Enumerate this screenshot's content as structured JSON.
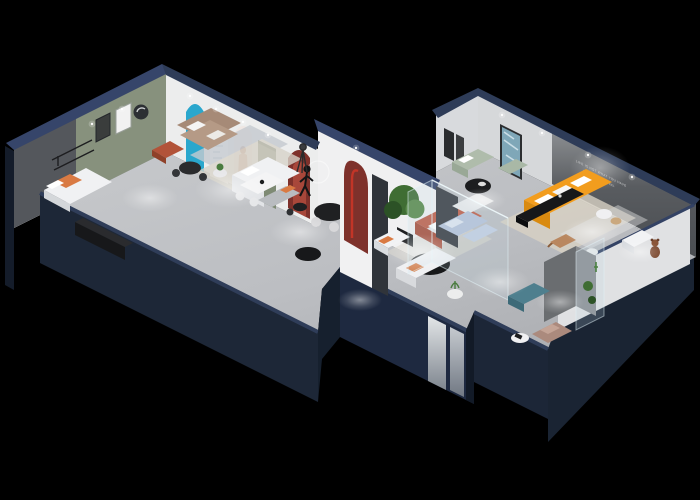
{
  "scene": {
    "title": "isometric-furniture-showroom-floor-plan",
    "wall_slogan": {
      "line1": "LIFE IS NOT WHAT YOU HAVE",
      "line2": "IT IS WHAT YOU FEEL"
    },
    "colors": {
      "bg": "#000000",
      "outerWallFace": "#1d2737",
      "outerWallSide": "#141c2a",
      "outerWallRight": "#1a2433",
      "wallCap": "#36456a",
      "capLine": "#2f3d59",
      "interiorWall": "#e9eaec",
      "interiorWallShade": "#d8dadd",
      "rightInnerWall": "#e0e1e3",
      "floor": "#bcbec2",
      "accentGreenWall": "#87917d",
      "darkAccentWall": "#54575c",
      "sloganWall": "#595c60",
      "posterCyan": "#2aa7cd",
      "archRed": "#7e312b",
      "archRedBright": "#c23527",
      "doorGreen": "#7e8a74",
      "sofaOrange": "#f29d1e",
      "sofaOrangeShade": "#d98a10",
      "sofaTerracotta": "#bf5f49",
      "sofaSage": "#afbcab",
      "sofaBlue": "#b5c3d9",
      "benchTeal": "#4e7f8e",
      "chairMauve": "#ab8a7d",
      "sofaBrown": "#a68a77",
      "ottomanCopper": "#b25339",
      "sofaWhite": "#f0f1f3",
      "furnitureBlack": "#17181a",
      "rugBeige": "#d9d2c4",
      "rugGray": "#c5cad0",
      "plantGreen": "#3f6d33",
      "plantGreenLight": "#59894a",
      "artTeal": "#7fa7b8",
      "teddyBrown": "#7c4a31",
      "woodTone": "#b9875f",
      "mirrorPanel": "#cfd3d6"
    },
    "rooms": [
      {
        "name": "lounge-room-left",
        "furniture": [
          "white daybed with orange cushion",
          "black media console",
          "wall shelf",
          "dark accent wall"
        ]
      },
      {
        "name": "gallery-room",
        "furniture": [
          "cyan arch poster",
          "white arch posters with model photo",
          "green door",
          "brown fabric sofa",
          "copper ottoman",
          "black bistro table with chairs",
          "white side table",
          "green accent wall with framed art",
          "red arch niche with black table"
        ]
      },
      {
        "name": "living-display",
        "furniture": [
          "white corner sofa",
          "white coffee table with chairs",
          "grey chaise with orange pillow",
          "black dining table with white chairs",
          "mannequin sculpture",
          "tripod floor lamp",
          "red arch pillar"
        ]
      },
      {
        "name": "glass-display-box",
        "furniture": [
          "light blue sofa set",
          "white display island",
          "glass partition walls",
          "large potted tree"
        ]
      },
      {
        "name": "center-lounge",
        "furniture": [
          "terracotta sofa with white cushions",
          "black oval coffee table",
          "white armchair with orange throw",
          "white sofa with orange pillows",
          "plant on side table"
        ]
      },
      {
        "name": "main-showroom-right",
        "furniture": [
          "orange corner sofa with white pillows",
          "black tv console",
          "beige area rug",
          "white armchair",
          "teddy bear figure",
          "wood lounge chair",
          "round side tables",
          "teal abstract art panel",
          "sage green sofa",
          "black round coffee table",
          "dark slogan wall"
        ]
      },
      {
        "name": "bottom-right-room",
        "furniture": [
          "teal ottoman bench",
          "mauve armchair",
          "magazine side table",
          "glass display cabinet with plants",
          "grey partition wall",
          "mirror door panels"
        ]
      }
    ]
  }
}
